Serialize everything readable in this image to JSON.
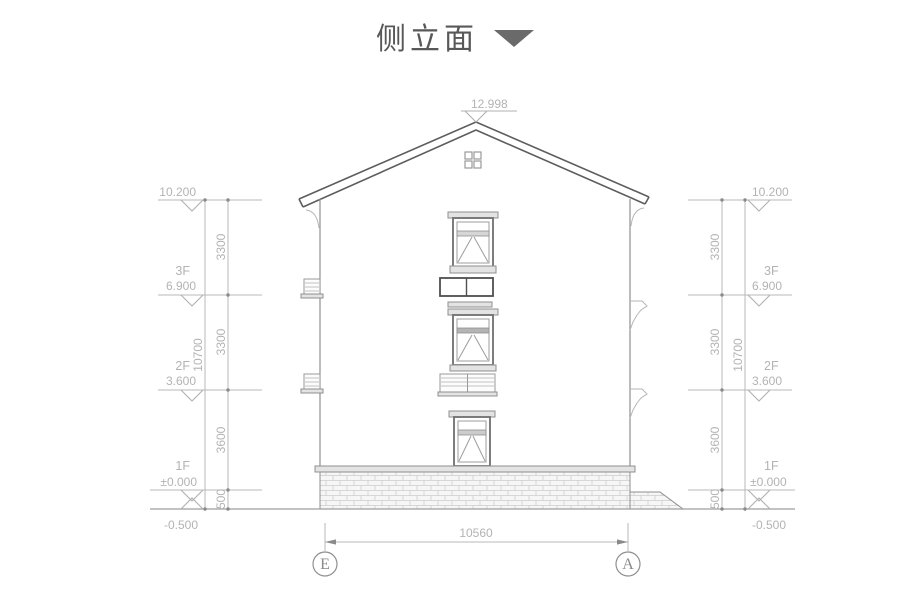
{
  "title": {
    "text": "侧立面"
  },
  "drawing": {
    "peak_elevation": "12.998",
    "bottom_width": "10560",
    "axis_left": "E",
    "axis_right": "A"
  },
  "left": {
    "top_elevation": "10.200",
    "floors": [
      {
        "name": "3F",
        "elevation": "6.900"
      },
      {
        "name": "2F",
        "elevation": "3.600"
      },
      {
        "name": "1F",
        "elevation": "±0.000"
      }
    ],
    "ground_elevation": "-0.500",
    "segments": [
      "3300",
      "3300",
      "3600",
      "500"
    ],
    "total": "10700"
  },
  "right": {
    "top_elevation": "10.200",
    "floors": [
      {
        "name": "3F",
        "elevation": "6.900"
      },
      {
        "name": "2F",
        "elevation": "3.600"
      },
      {
        "name": "1F",
        "elevation": "±0.000"
      }
    ],
    "ground_elevation": "-0.500",
    "segments": [
      "3300",
      "3300",
      "3600",
      "500"
    ],
    "total": "10700"
  },
  "colors": {
    "dimension_line": "#b9b9b9",
    "building_line": "#8f8f8f",
    "title_text": "#585858"
  }
}
